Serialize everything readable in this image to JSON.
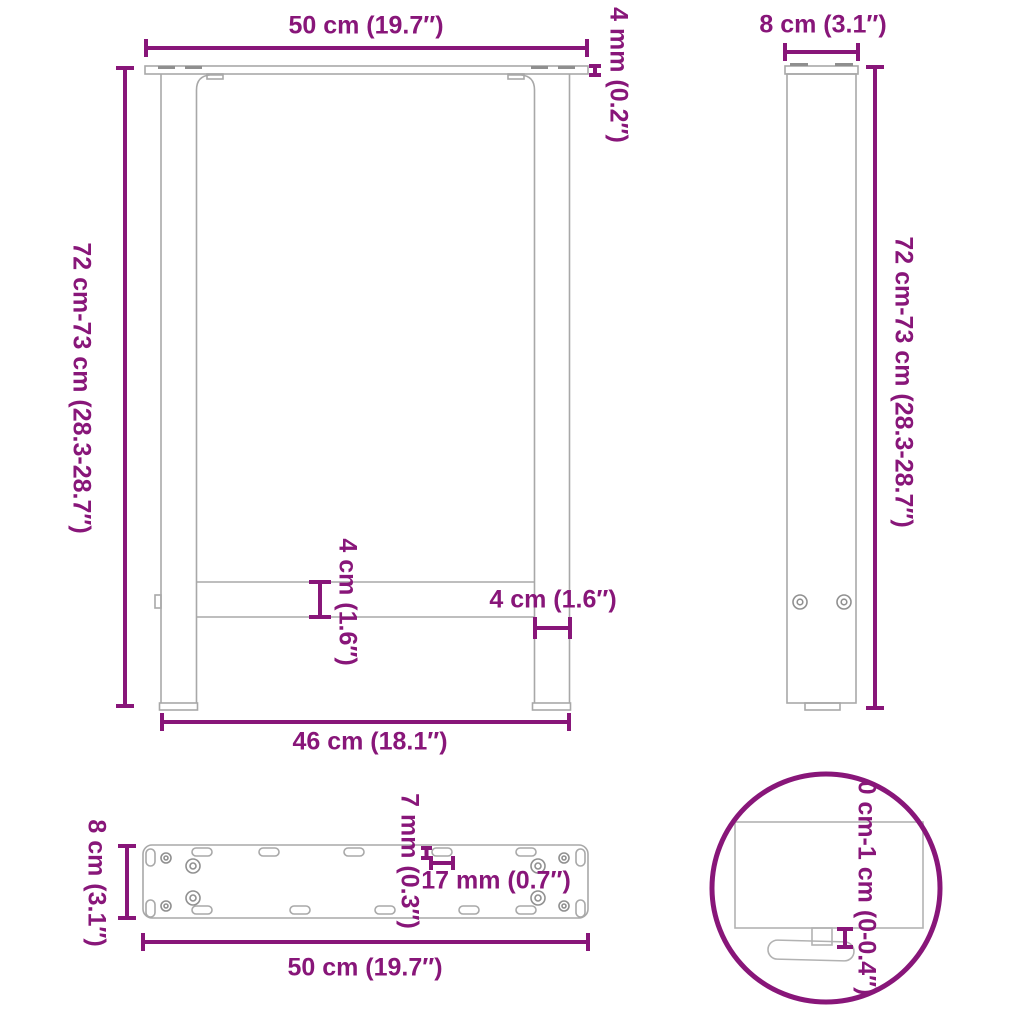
{
  "title": "Table leg dimensions diagram",
  "colors": {
    "dimension_accent": "#881679",
    "drawing_outline": "#a8a8a8"
  },
  "views": {
    "front": {
      "width_top": "50 cm (19.7″)",
      "plate_thickness": "4 mm (0.2″)",
      "height": "72 cm-73 cm (28.3-28.7″)",
      "crossbar_height": "4 cm (1.6″)",
      "leg_width": "4 cm (1.6″)",
      "width_bottom": "46 cm (18.1″)"
    },
    "side": {
      "depth": "8 cm (3.1″)",
      "height": "72 cm-73 cm (28.3-28.7″)"
    },
    "mounting_plate": {
      "depth": "8 cm (3.1″)",
      "slot_height": "7 mm (0.3″)",
      "slot_width": "17 mm (0.7″)",
      "width": "50 cm (19.7″)"
    },
    "foot_detail": {
      "adjustable_range": "0 cm-1 cm (0-0.4″)"
    }
  }
}
